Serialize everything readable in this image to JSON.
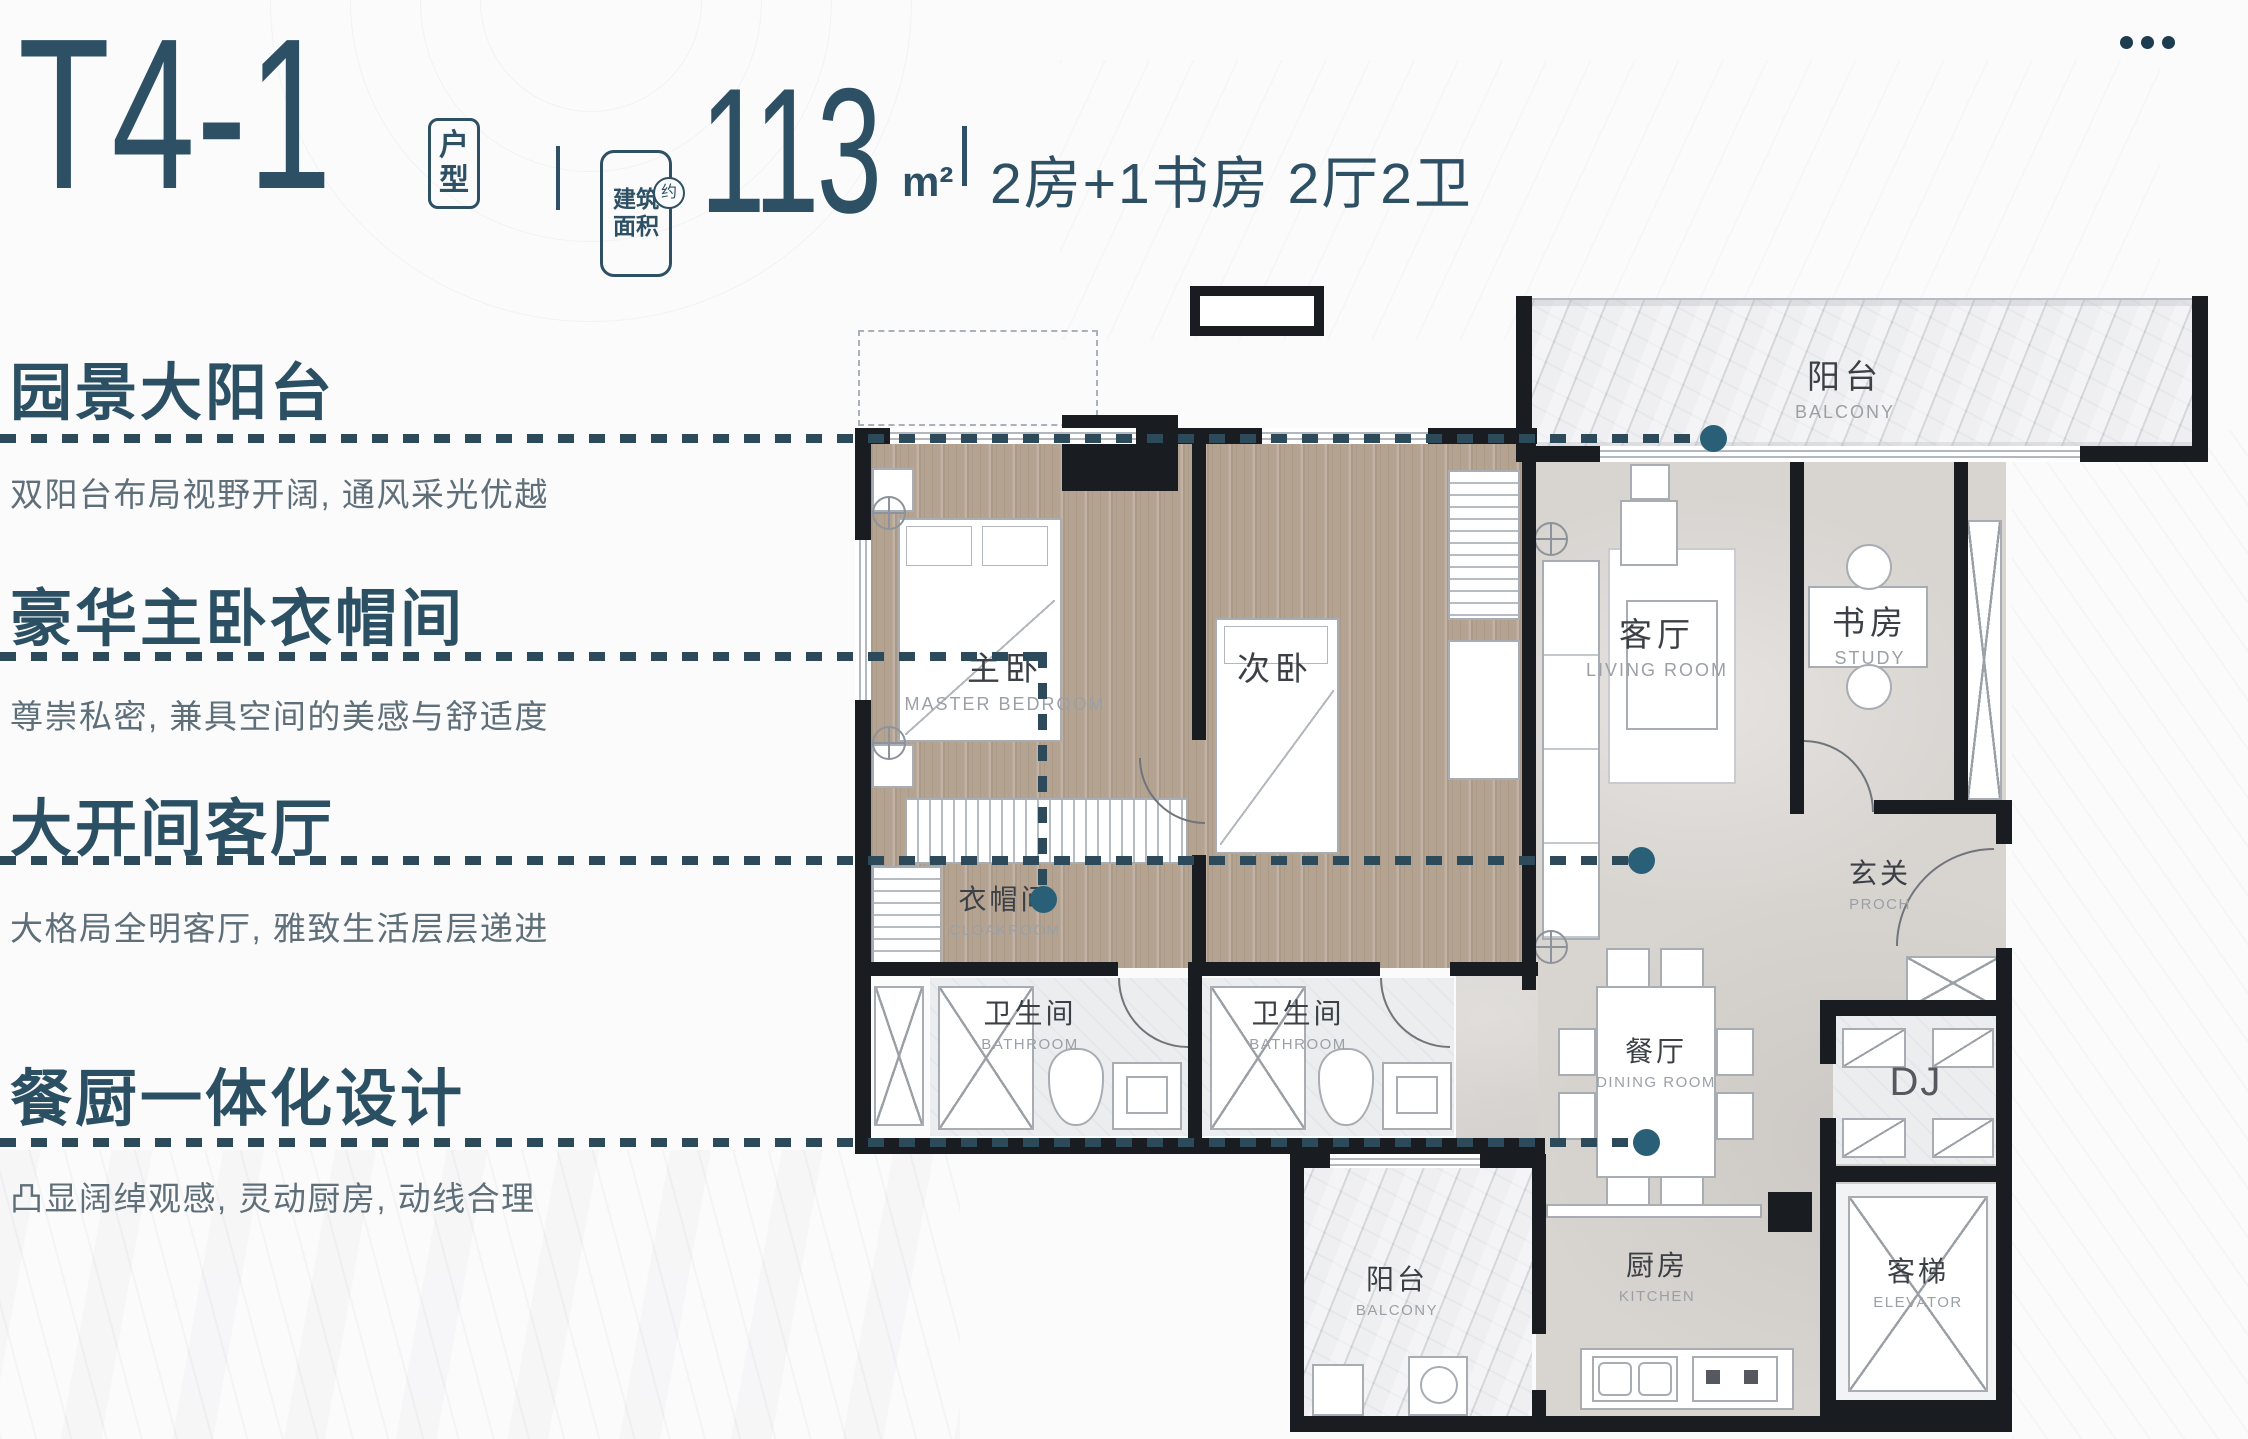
{
  "window": {
    "more_icon": "more-dots"
  },
  "header": {
    "title": "T4-1",
    "unit_tag": "户\n型",
    "area_label": "建筑\n面积",
    "area_approx": "约",
    "area_value": "113",
    "area_unit": "m²",
    "layout_summary": "2房+1书房 2厅2卫"
  },
  "features": [
    {
      "heading": "园景大阳台",
      "description": "双阳台布局视野开阔, 通风采光优越"
    },
    {
      "heading": "豪华主卧衣帽间",
      "description": "尊崇私密, 兼具空间的美感与舒适度"
    },
    {
      "heading": "大开间客厅",
      "description": "大格局全明客厅, 雅致生活层层递进"
    },
    {
      "heading": "餐厨一体化设计",
      "description": "凸显阔绰观感, 灵动厨房, 动线合理"
    }
  ],
  "floorplan": {
    "rooms": [
      {
        "id": "balcony-top",
        "zh": "阳台",
        "en": "BALCONY"
      },
      {
        "id": "master-bedroom",
        "zh": "主卧",
        "en": "MASTER BEDROOM"
      },
      {
        "id": "second-bedroom",
        "zh": "次卧",
        "en": ""
      },
      {
        "id": "living-room",
        "zh": "客厅",
        "en": "LIVING ROOM"
      },
      {
        "id": "study",
        "zh": "书房",
        "en": "STUDY"
      },
      {
        "id": "cloakroom",
        "zh": "衣帽间",
        "en": "CLOAKROOM"
      },
      {
        "id": "porch",
        "zh": "玄关",
        "en": "PROCH"
      },
      {
        "id": "bathroom-1",
        "zh": "卫生间",
        "en": "BATHROOM"
      },
      {
        "id": "bathroom-2",
        "zh": "卫生间",
        "en": "BATHROOM"
      },
      {
        "id": "dining-room",
        "zh": "餐厅",
        "en": "DINING ROOM"
      },
      {
        "id": "dj",
        "zh": "DJ",
        "en": ""
      },
      {
        "id": "balcony-bottom",
        "zh": "阳台",
        "en": "BALCONY"
      },
      {
        "id": "kitchen",
        "zh": "厨房",
        "en": "KITCHEN"
      },
      {
        "id": "elevator",
        "zh": "客梯",
        "en": "ELEVATOR"
      }
    ]
  },
  "colors": {
    "accent": "#2d5064",
    "leader_dash": "#2d4a5a",
    "leader_dot": "#2a6077",
    "wall": "#191c20",
    "wood_floor": "#b5a392",
    "stone_floor": "#d8d4d0",
    "marble_floor": "#e6e7ea"
  }
}
